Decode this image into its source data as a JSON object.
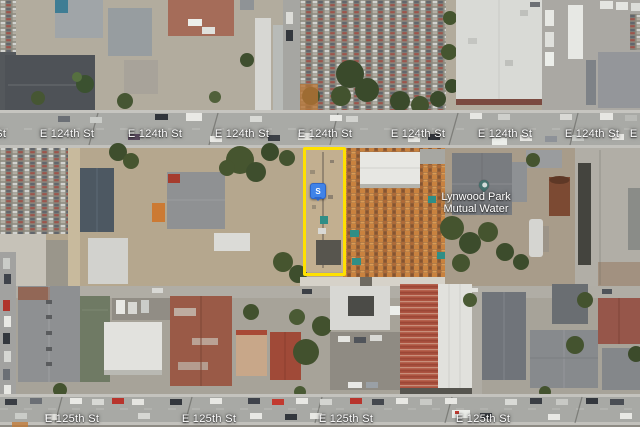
{
  "map": {
    "view": "satellite",
    "colors": {
      "highlight": "#FFE100",
      "marker": "#4083E8",
      "marker_border": "#2E66C9",
      "poi_pin": "#44736E",
      "poi_pin_inner": "#D4DCDA",
      "label_text": "#FFFFFF"
    },
    "streets": [
      {
        "name": "E 124th St",
        "label_y": 134,
        "label_xs": [
          -21,
          67,
          155,
          242,
          325,
          418,
          505,
          592,
          657
        ]
      },
      {
        "name": "E 125th St",
        "label_y": 419,
        "label_xs": [
          72,
          209,
          346,
          483
        ]
      }
    ],
    "poi": {
      "lines": [
        "Lynwood Park",
        "Mutual Water"
      ],
      "label_x": 476,
      "label_y": 192,
      "pin_x": 484,
      "pin_y": 190
    },
    "marker": {
      "glyph": "S",
      "x": 318,
      "y": 183
    },
    "highlight": {
      "x": 303,
      "y": 147,
      "w": 37,
      "h": 123
    }
  }
}
